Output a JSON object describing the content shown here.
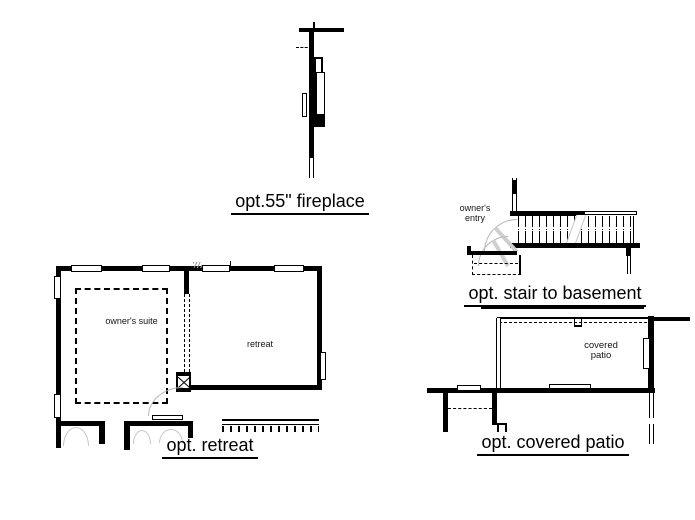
{
  "canvas": {
    "background": "#ffffff",
    "line_color": "#000000",
    "door_arc_color": "#c0c0c0"
  },
  "details": {
    "fireplace": {
      "title": "opt.55\" fireplace"
    },
    "stair_basement": {
      "title": "opt. stair to basement",
      "labels": {
        "owners_entry": "owner's entry"
      }
    },
    "retreat": {
      "title": "opt. retreat",
      "labels": {
        "owners_suite": "owner's suite",
        "retreat": "retreat"
      }
    },
    "covered_patio": {
      "title": "opt. covered patio",
      "labels": {
        "covered_patio": "covered patio"
      }
    }
  }
}
